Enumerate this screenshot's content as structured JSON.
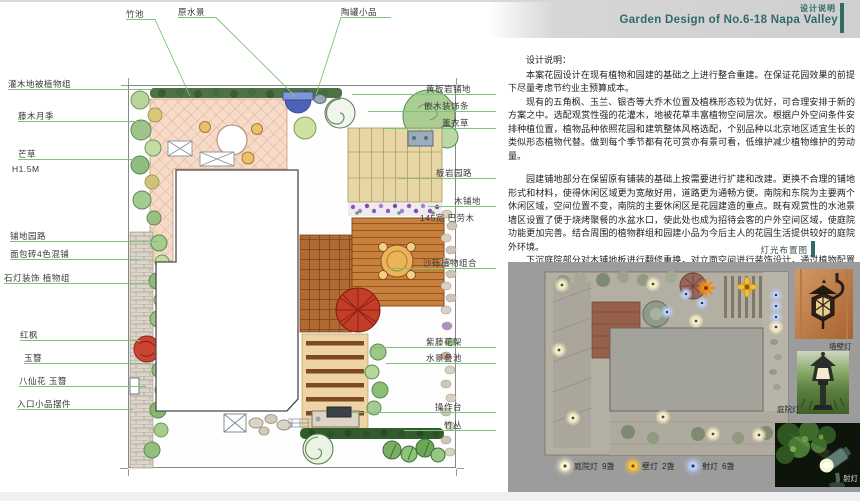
{
  "header": {
    "tag": "设计说明",
    "title": "Garden Design of  No.6-18 Napa Valley"
  },
  "design_notes": {
    "heading": "设计说明：",
    "paragraphs": [
      "本案花园设计在现有植物和园建的基础之上进行整合重建。在保证花园效果的前提下尽量考虑节约业主预算成本。",
      "现有的五角枫、玉兰、银杏等大乔木位置及植株形态较为优好，可合理安排于新的方案之中。选配观赏性强的花灌木，地被花草丰富植物空间层次。根据户外空间条件安排种植位置，植物品种依照花园和建筑整体风格选配，个别品种以北京地区适宜生长的类似形态植物代替。做到每个季节都有花可赏亦有景可看，低维护减少植物维护的劳动量。",
      "园建铺地部分在保留原有铺装的基础上按需要进行扩建和改建。更换不合理的铺地形式和材料，使得休闲区域更为宽敞好用，道路更为通畅方便。南院和东院为主要两个休闲区域，空间位置不变，南院的主要休闲区是花园建造的重点。既有观赏性的水池景墙区设置了便于烧烤聚餐的水盆水口，使此处也成为招待会客的户外空间区域，使庭院功能更加完善。结合周围的植物群组和园建小品为今后主人的花园生活提供较好的庭院外环境。",
      "下沉庭院部分对木铺地板进行翻修重换，对立面空间进行装饰设计，通过植物配置和装饰小品渲染环境气氛，发挥此处私密安静的独特环境条件。",
      "花园照明为基础照明和装饰性照明两大部分。基础照明以庭院灯、草坪灯在夜里照亮园路和休闲区域，再配以装饰射灯渲染夜景氛围。",
      "花园灌溉重新铺设地下管线，在绿地各处设置灌溉水口，方便浇灌园地。"
    ]
  },
  "plan": {
    "labels_top": [
      "竹池",
      "原水景",
      "陶罐小品"
    ],
    "labels_left": [
      "灌木地被植物组",
      "藤木月季",
      "芒草",
      "H1.5M",
      "铺地园路",
      "面包砖4色混铺",
      "石灯装饰  植物组",
      "红枫",
      "玉簪",
      "八仙花  玉簪",
      "入口小品摆件"
    ],
    "labels_right": [
      "黄板岩铺地",
      "嵌木装饰条",
      "薰衣草",
      "板岩园路",
      "木铺地",
      "145宽  巴劳木",
      "沙砾植物组合",
      "紫藤花架",
      "水景叠池",
      "操作台",
      "竹丛"
    ]
  },
  "lighting": {
    "section_title": "灯光布置图",
    "legend": [
      {
        "label": "庭院灯",
        "count": "9盏",
        "color": "#f7edc9"
      },
      {
        "label": "壁灯",
        "count": "2盏",
        "color": "#f5b63a"
      },
      {
        "label": "射灯",
        "count": "6盏",
        "color": "#a9c4f2"
      }
    ],
    "photo_captions": [
      "墙壁灯",
      "庭院灯",
      "射灯"
    ]
  },
  "colors": {
    "accent_teal": "#2e6b66",
    "leader_green": "#7cc47c",
    "panel_gray": "#9c9c9c"
  }
}
